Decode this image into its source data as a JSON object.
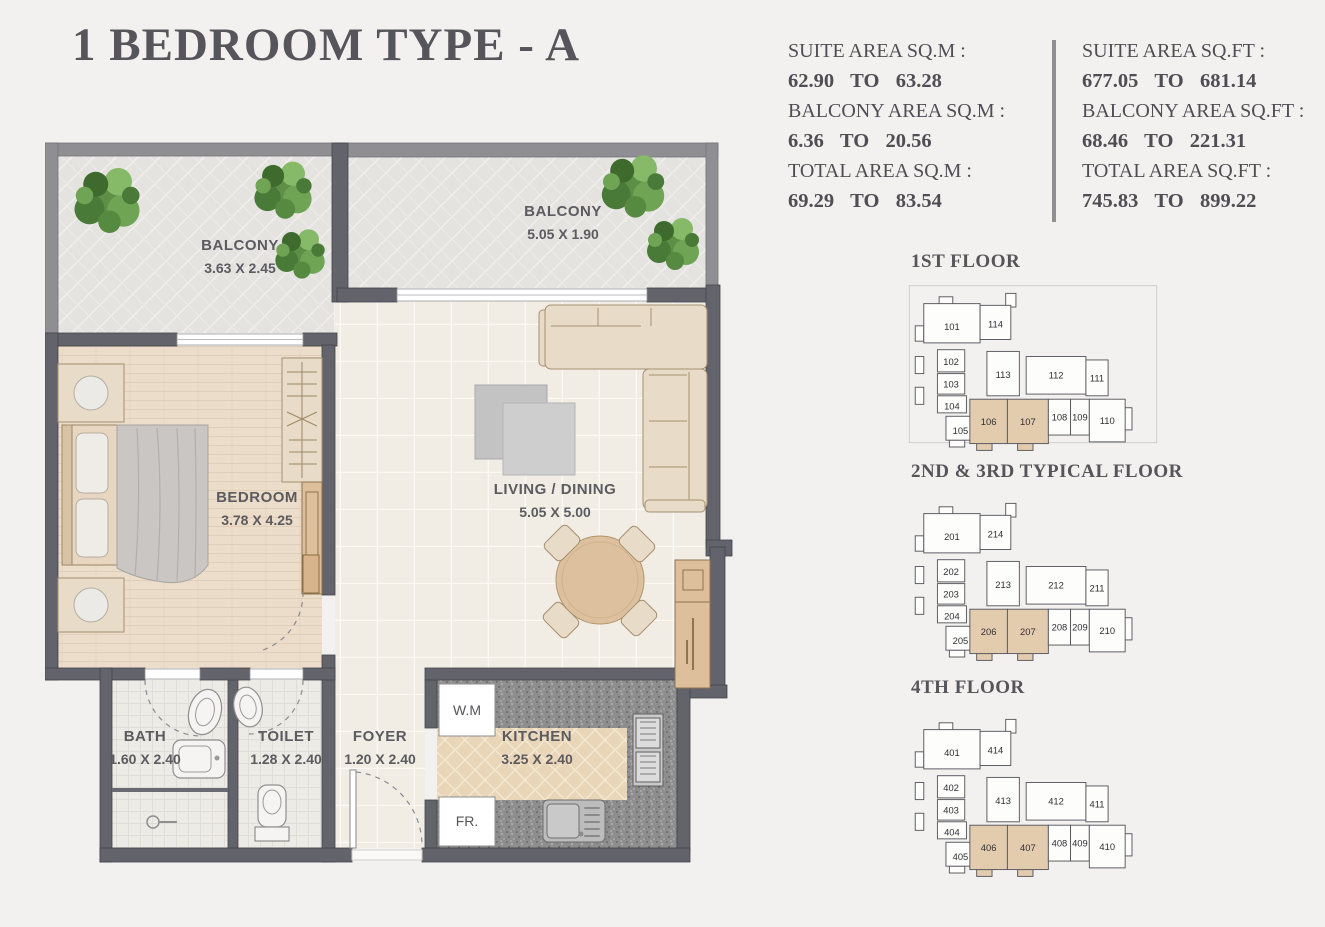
{
  "title": "1 BEDROOM TYPE - A",
  "area_summary": {
    "sqm": {
      "suite_label": "SUITE AREA SQ.M :",
      "suite_value": "62.90 TO 63.28",
      "balcony_label": "BALCONY AREA SQ.M :",
      "balcony_value": "6.36 TO 20.56",
      "total_label": "TOTAL AREA SQ.M :",
      "total_value": "69.29 TO 83.54"
    },
    "sqft": {
      "suite_label": "SUITE AREA SQ.FT :",
      "suite_value": "677.05 TO 681.14",
      "balcony_label": "BALCONY AREA SQ.FT :",
      "balcony_value": "68.46 TO 221.31",
      "total_label": "TOTAL AREA SQ.FT :",
      "total_value": "745.83 TO 899.22"
    }
  },
  "floor_plan": {
    "rooms": [
      {
        "name": "BALCONY",
        "dims": "3.63 X 2.45"
      },
      {
        "name": "BALCONY",
        "dims": "5.05 X 1.90"
      },
      {
        "name": "BEDROOM",
        "dims": "3.78 X 4.25"
      },
      {
        "name": "LIVING / DINING",
        "dims": "5.05 X 5.00"
      },
      {
        "name": "BATH",
        "dims": "1.60 X 2.40"
      },
      {
        "name": "TOILET",
        "dims": "1.28 X 2.40"
      },
      {
        "name": "FOYER",
        "dims": "1.20 X 2.40"
      },
      {
        "name": "KITCHEN",
        "dims": "3.25 X 2.40"
      }
    ],
    "appliances": {
      "washing_machine": "W.M",
      "fridge": "FR."
    }
  },
  "key_plans": [
    {
      "title": "1ST FLOOR",
      "highlighted_units": [
        "106",
        "107"
      ],
      "units": [
        "101",
        "102",
        "103",
        "104",
        "105",
        "106",
        "107",
        "108",
        "109",
        "110",
        "111",
        "112",
        "113",
        "114"
      ]
    },
    {
      "title": "2ND & 3RD TYPICAL FLOOR",
      "highlighted_units": [
        "206",
        "207"
      ],
      "units": [
        "201",
        "202",
        "203",
        "204",
        "205",
        "206",
        "207",
        "208",
        "209",
        "210",
        "211",
        "212",
        "213",
        "214"
      ]
    },
    {
      "title": "4TH FLOOR",
      "highlighted_units": [
        "406",
        "407"
      ],
      "units": [
        "401",
        "402",
        "403",
        "404",
        "405",
        "406",
        "407",
        "408",
        "409",
        "410",
        "411",
        "412",
        "413",
        "414"
      ]
    }
  ],
  "colors": {
    "background": "#f2f1ef",
    "wall": "#63636b",
    "balcony_wall": "#8f8f93",
    "highlight": "#e3cbae",
    "text": "#55555b",
    "wood_floor": "#ecddca",
    "granite": "#8e8e8e",
    "greenery": "#5d8f46"
  }
}
